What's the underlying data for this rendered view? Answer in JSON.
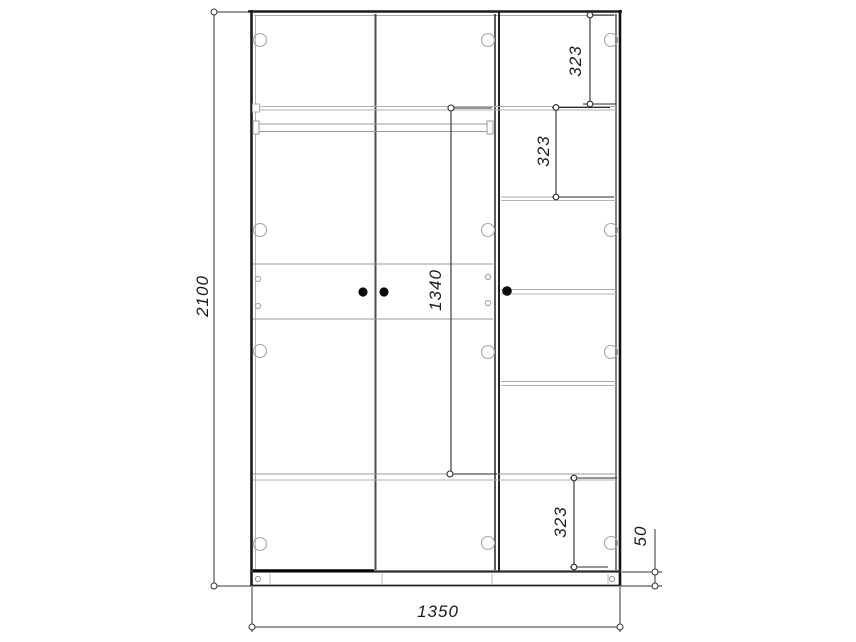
{
  "drawing": {
    "title": "wardrobe-front-elevation",
    "dims": {
      "overall_height": {
        "label": "2100"
      },
      "overall_width": {
        "label": "1350"
      },
      "hanging_height": {
        "label": "1340"
      },
      "top_shelf": {
        "label": "323"
      },
      "second_shelf": {
        "label": "323"
      },
      "bottom_shelf": {
        "label": "323"
      },
      "plinth_height": {
        "label": "50"
      }
    },
    "colors": {
      "background": "#ffffff",
      "line_primary": "#1c1c1c",
      "line_secondary": "#8a8a8a",
      "line_faint": "#b4b4b4",
      "dimension_line": "#333333",
      "handle": "#0a0a0a"
    }
  }
}
